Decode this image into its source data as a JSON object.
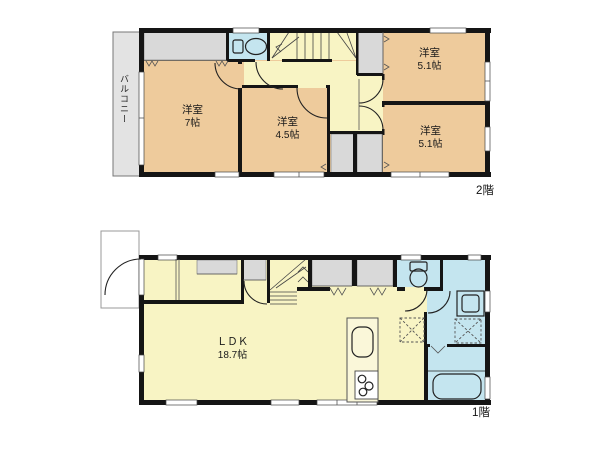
{
  "floor2": {
    "floor_label": "2階",
    "balcony_label": "バルコニー",
    "rooms": {
      "northwest": {
        "name": "洋室",
        "size": "7帖"
      },
      "center": {
        "name": "洋室",
        "size": "4.5帖"
      },
      "northeast": {
        "name": "洋室",
        "size": "5.1帖"
      },
      "southeast": {
        "name": "洋室",
        "size": "5.1帖"
      }
    }
  },
  "floor1": {
    "floor_label": "1階",
    "ldk": {
      "name": "ＬＤＫ",
      "size": "18.7帖"
    }
  },
  "icons": [
    "toilet-icon",
    "bathtub-icon",
    "vanity-sink-icon",
    "kitchen-sink-icon",
    "stove-icon",
    "washing-machine-pan-icon",
    "refrigerator-space-icon",
    "stairs-icon",
    "door-swing-arc",
    "folding-door-mark",
    "window-mark"
  ],
  "colors": {
    "room": "#eecb9c",
    "hall": "#f8f4c4",
    "wet": "#c4e5ef",
    "closet": "#d9d9d9",
    "balcony": "#e3e3e3",
    "wall": "#151515",
    "line": "#333333"
  }
}
